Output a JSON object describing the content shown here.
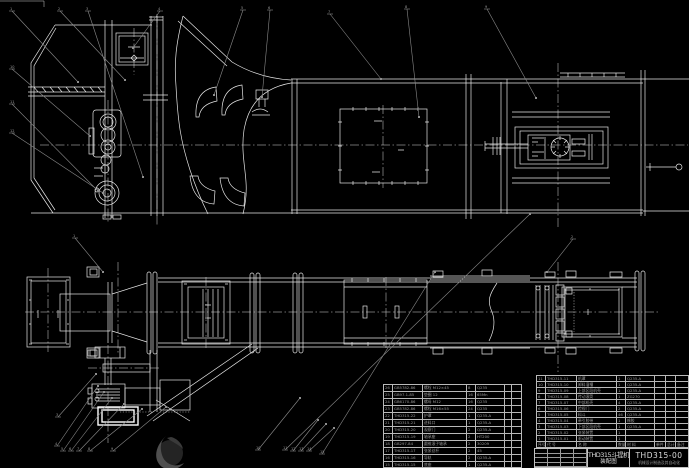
{
  "colors": {
    "background": "#000000",
    "lines": "#e6e6e6",
    "leaders": "#8a8a8a",
    "table_text": "#9a9a9a"
  },
  "title_block": {
    "product": "THD315斗提机",
    "drawing_type": "装配图",
    "drawing_no": "THD315-00",
    "org_line": "机械设计制造及其自动化"
  },
  "bom_right": {
    "rows": [
      [
        "11",
        "THD315-11",
        "机罩",
        "1",
        "Q235-A",
        "",
        "",
        ""
      ],
      [
        "10",
        "THD315-10",
        "卸料溜槽",
        "1",
        "Q235-A",
        "",
        "",
        ""
      ],
      [
        "9",
        "THD315-09",
        "上部区段机壳",
        "1",
        "Q235-A",
        "",
        "",
        ""
      ],
      [
        "8",
        "THD315-08",
        "传动滚筒",
        "1",
        "ZG270",
        "",
        "",
        ""
      ],
      [
        "7",
        "THD315-07",
        "中部机壳",
        "4",
        "Q235-A",
        "",
        "",
        ""
      ],
      [
        "6",
        "THD315-06",
        "检视门",
        "2",
        "Q235-A",
        "",
        "",
        ""
      ],
      [
        "5",
        "THD315-05",
        "料斗",
        "46",
        "Q235-A",
        "",
        "",
        ""
      ],
      [
        "4",
        "THD315-04",
        "牵引胶带",
        "1",
        "橡胶",
        "",
        "",
        ""
      ],
      [
        "3",
        "THD315-03",
        "下部区段机壳",
        "1",
        "Q235-A",
        "",
        "",
        ""
      ],
      [
        "2",
        "THD315-02",
        "张紧装置",
        "1",
        "",
        "",
        "",
        ""
      ],
      [
        "1",
        "THD315-01",
        "驱动装置",
        "1",
        "",
        "",
        "",
        ""
      ]
    ],
    "headers": [
      "序号",
      "代 号",
      "名 称",
      "数量",
      "材 料",
      "单件",
      "总计",
      "备注"
    ]
  },
  "bom_left": {
    "rows": [
      [
        "26",
        "GB5782-86",
        "螺栓 M12×45",
        "8",
        "Q235",
        "",
        ""
      ],
      [
        "25",
        "GB97.1-85",
        "垫圈 12",
        "16",
        "65Mn",
        "",
        ""
      ],
      [
        "24",
        "GB6170-86",
        "螺母 M12",
        "16",
        "Q235",
        "",
        ""
      ],
      [
        "23",
        "GB5782-86",
        "螺栓 M16×55",
        "24",
        "Q235",
        "",
        ""
      ],
      [
        "22",
        "THD315-22",
        "护罩",
        "1",
        "Q235-A",
        "",
        ""
      ],
      [
        "21",
        "THD315-21",
        "进料口",
        "1",
        "Q235-A",
        "",
        ""
      ],
      [
        "20",
        "THD315-20",
        "观察门",
        "2",
        "Q235-A",
        "",
        ""
      ],
      [
        "19",
        "THD315-19",
        "轴承座",
        "2",
        "HT200",
        "",
        ""
      ],
      [
        "18",
        "GB297-84",
        "圆锥滚子轴承",
        "2",
        "30209",
        "",
        ""
      ],
      [
        "17",
        "THD315-17",
        "张紧丝杆",
        "2",
        "45",
        "",
        ""
      ],
      [
        "16",
        "THD315-16",
        "导轨",
        "2",
        "Q235-A",
        "",
        ""
      ],
      [
        "15",
        "THD315-15",
        "底座",
        "1",
        "Q235-A",
        "",
        ""
      ]
    ]
  },
  "callouts": [
    {
      "n": "1",
      "bx": 12,
      "by": 9,
      "tx": 78,
      "ty": 82
    },
    {
      "n": "2",
      "bx": 60,
      "by": 9,
      "tx": 125,
      "ty": 80
    },
    {
      "n": "3",
      "bx": 88,
      "by": 9,
      "tx": 143,
      "ty": 177
    },
    {
      "n": "4",
      "bx": 160,
      "by": 9,
      "tx": 133,
      "ty": 48
    },
    {
      "n": "5",
      "bx": 243,
      "by": 8,
      "tx": 214,
      "ty": 95
    },
    {
      "n": "6",
      "bx": 270,
      "by": 8,
      "tx": 262,
      "ty": 97
    },
    {
      "n": "7",
      "bx": 330,
      "by": 12,
      "tx": 381,
      "ty": 79
    },
    {
      "n": "8",
      "bx": 407,
      "by": 7,
      "tx": 419,
      "ty": 117
    },
    {
      "n": "9",
      "bx": 487,
      "by": 7,
      "tx": 536,
      "ty": 98
    },
    {
      "n": "10",
      "bx": 12,
      "by": 67,
      "tx": 90,
      "ty": 136
    },
    {
      "n": "11",
      "bx": 12,
      "by": 102,
      "tx": 98,
      "ty": 191
    },
    {
      "n": "12",
      "bx": 12,
      "by": 131,
      "tx": 103,
      "ty": 193
    },
    {
      "n": "1",
      "bx": 75,
      "by": 236,
      "tx": 103,
      "ty": 272
    },
    {
      "n": "2",
      "bx": 573,
      "by": 237,
      "tx": 547,
      "ty": 272
    },
    {
      "n": "3",
      "bx": 58,
      "by": 415,
      "tx": 96,
      "ty": 374
    },
    {
      "n": "4",
      "bx": 57,
      "by": 444,
      "tx": 98,
      "ty": 386
    },
    {
      "n": "5",
      "bx": 63,
      "by": 449,
      "tx": 104,
      "ty": 392
    },
    {
      "n": "6",
      "bx": 71,
      "by": 449,
      "tx": 112,
      "ty": 398
    },
    {
      "n": "7",
      "bx": 79,
      "by": 449,
      "tx": 124,
      "ty": 404
    },
    {
      "n": "8",
      "bx": 90,
      "by": 449,
      "tx": 142,
      "ty": 409
    },
    {
      "n": "9",
      "bx": 113,
      "by": 449,
      "tx": 166,
      "ty": 407
    },
    {
      "n": "10",
      "bx": 258,
      "by": 448,
      "tx": 300,
      "ty": 398
    },
    {
      "n": "11",
      "bx": 285,
      "by": 448,
      "tx": 530,
      "ty": 214
    },
    {
      "n": "12",
      "bx": 293,
      "by": 449,
      "tx": 318,
      "ty": 420
    },
    {
      "n": "13",
      "bx": 301,
      "by": 449,
      "tx": 326,
      "ty": 424
    },
    {
      "n": "14",
      "bx": 309,
      "by": 449,
      "tx": 334,
      "ty": 428
    },
    {
      "n": "15",
      "bx": 322,
      "by": 452,
      "tx": 435,
      "ty": 272
    }
  ]
}
